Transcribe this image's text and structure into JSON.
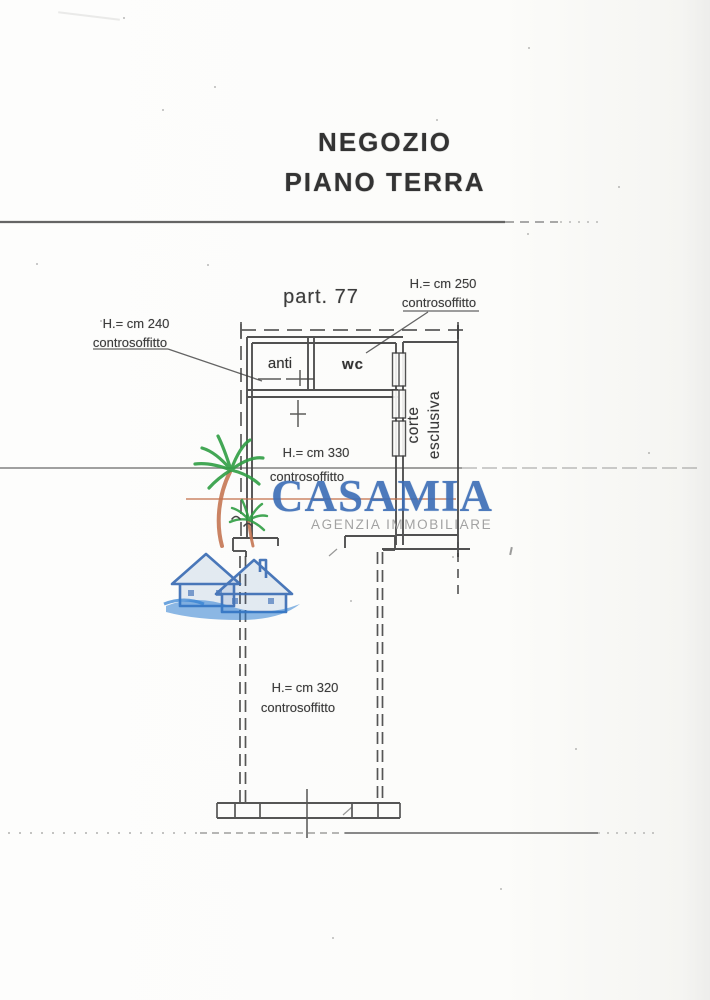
{
  "header": {
    "title_line1": "NEGOZIO",
    "title_line2": "PIANO TERRA"
  },
  "plan": {
    "parcel_label": "part. 77",
    "rooms": {
      "anti": {
        "label": "anti"
      },
      "wc": {
        "label": "wc"
      },
      "corte": {
        "line1": "corte",
        "line2": "esclusiva"
      }
    },
    "notes": {
      "h240": {
        "height": "H.= cm 240",
        "caption": "controsoffitto"
      },
      "h250": {
        "height": "H.= cm 250",
        "caption": "controsoffitto"
      },
      "h330": {
        "height": "H.= cm 330",
        "caption": "controsoffitto"
      },
      "h320": {
        "height": "H.= cm 320",
        "caption": "controsoffitto"
      }
    }
  },
  "watermark": {
    "brand": "CASAMIA",
    "tagline": "AGENZIA IMMOBILIARE",
    "colors": {
      "brand_blue": "#3b6db6",
      "tagline_gray": "#9e9e9e",
      "palm_green": "#2f9e44",
      "trunk_orange": "#c4734f",
      "wave_blue": "#2d7dd2"
    }
  },
  "scan": {
    "ink": "#3f3f3f",
    "paper": "#fbfbf9"
  }
}
